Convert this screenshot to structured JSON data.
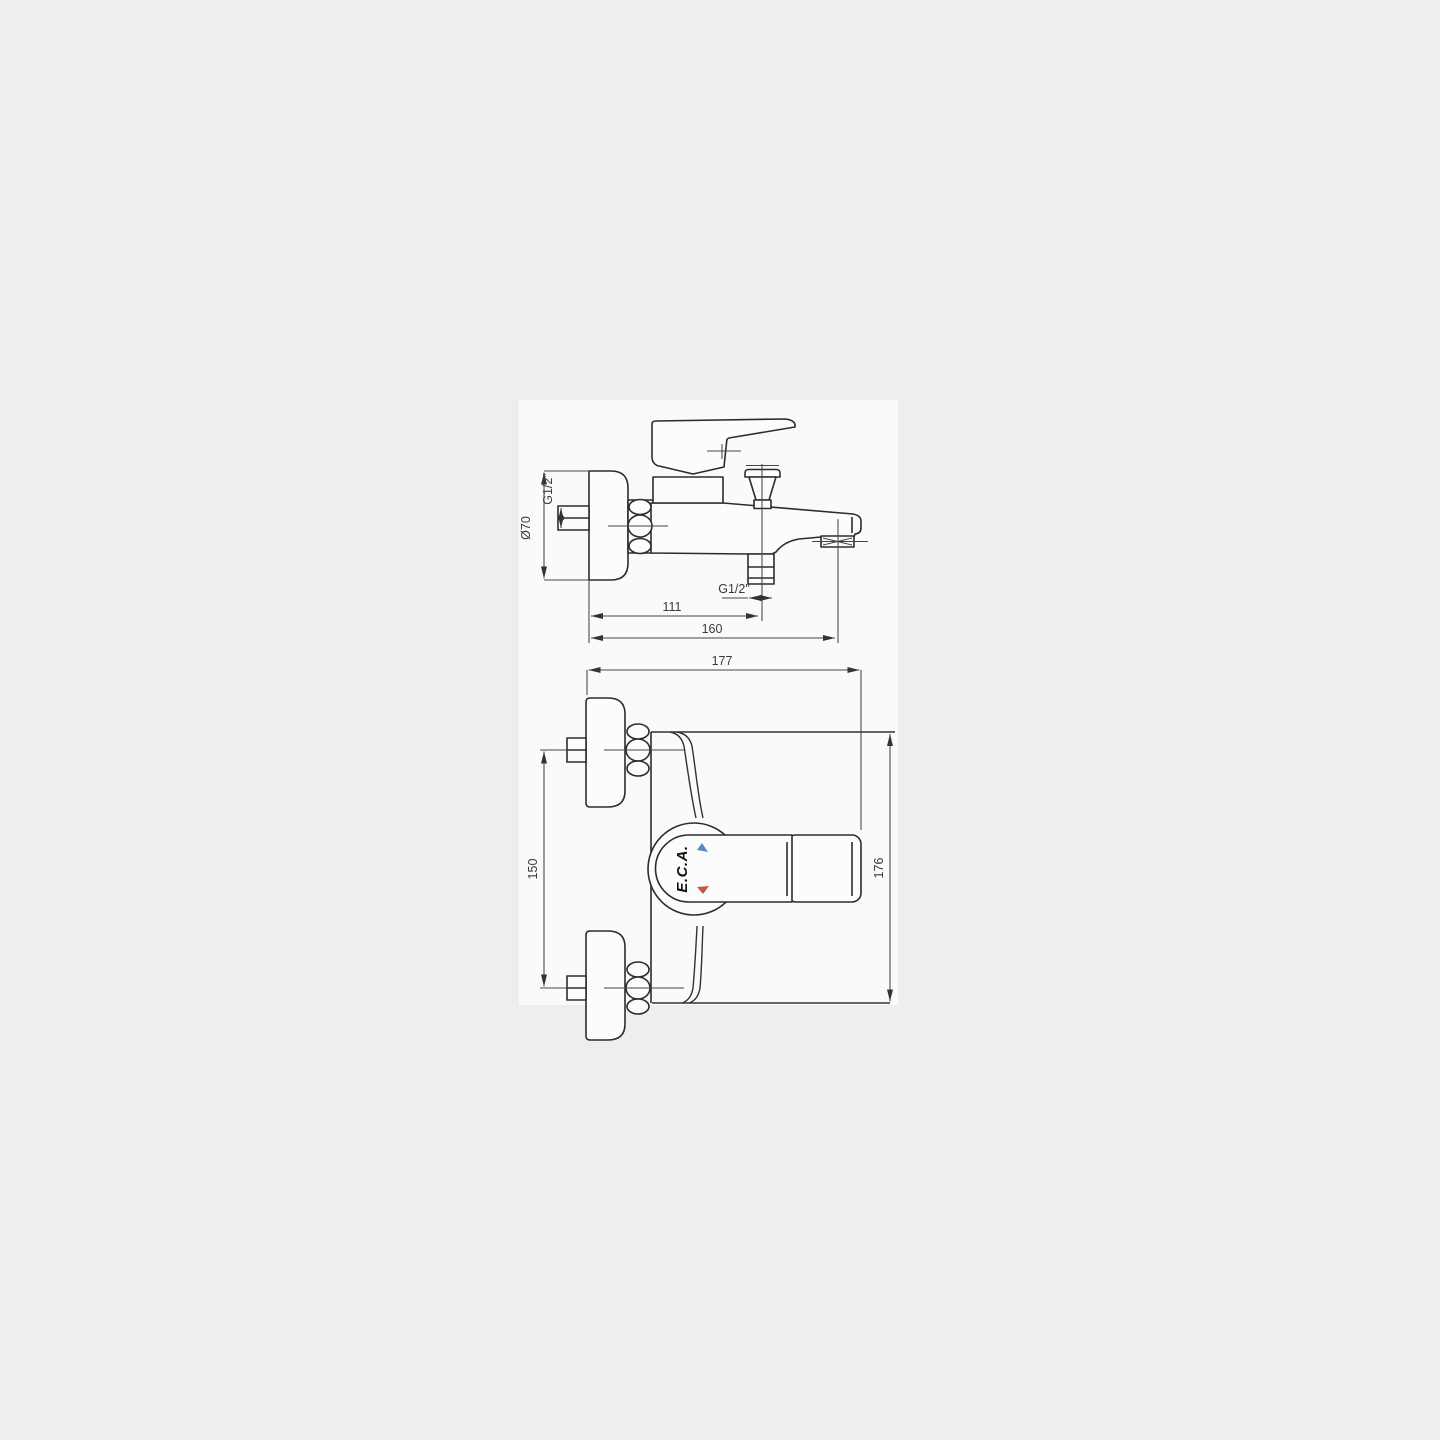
{
  "drawing": {
    "kind": "technical dimension drawing",
    "subject": "wall-mounted single-lever bath/shower mixer faucet, two orthographic views",
    "brand_logo": "E.C.A.",
    "colors": {
      "background": "#edefee",
      "paper": "#fafaf9",
      "line": "#2c2c2c",
      "cold_indicator": "#5b87c0",
      "hot_indicator": "#c4574a"
    },
    "dims": {
      "dia70": "Ø70",
      "g12_inlet": "G1/2\"",
      "g12_shower": "G1/2\"",
      "d111": "111",
      "d160": "160",
      "d177": "177",
      "d150": "150",
      "d176": "176"
    },
    "logo": {
      "text": "E.C.A."
    }
  }
}
